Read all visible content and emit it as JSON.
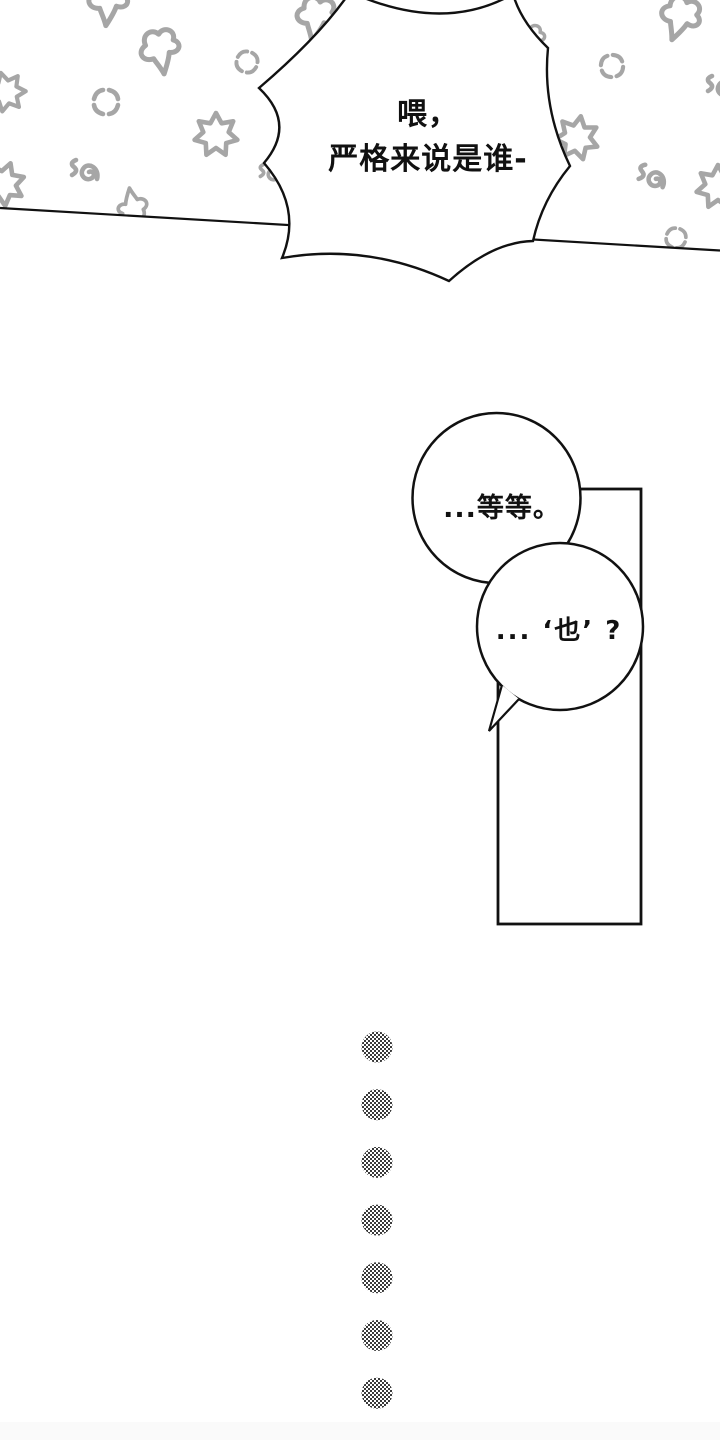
{
  "page": {
    "kind": "webtoon-comic-page",
    "background": "#ffffff"
  },
  "top_panel": {
    "shout_bubble": {
      "line1": "喂，",
      "line2": "严格来说是谁-"
    },
    "pattern_doodles": {
      "icons": [
        "anger-mark",
        "puff-cloud",
        "burst-star",
        "swirl"
      ],
      "color": "#a6a6a6"
    }
  },
  "middle_panel": {
    "bubble1": {
      "text": "...等等。"
    },
    "bubble2": {
      "text": "... ‘也’ ?"
    }
  },
  "ellipsis_dots": {
    "count": 7,
    "style": "halftone-checker"
  },
  "colors": {
    "ink": "#111111",
    "doodle_gray": "#a6a6a6",
    "bottom_band": "#fafafa"
  }
}
